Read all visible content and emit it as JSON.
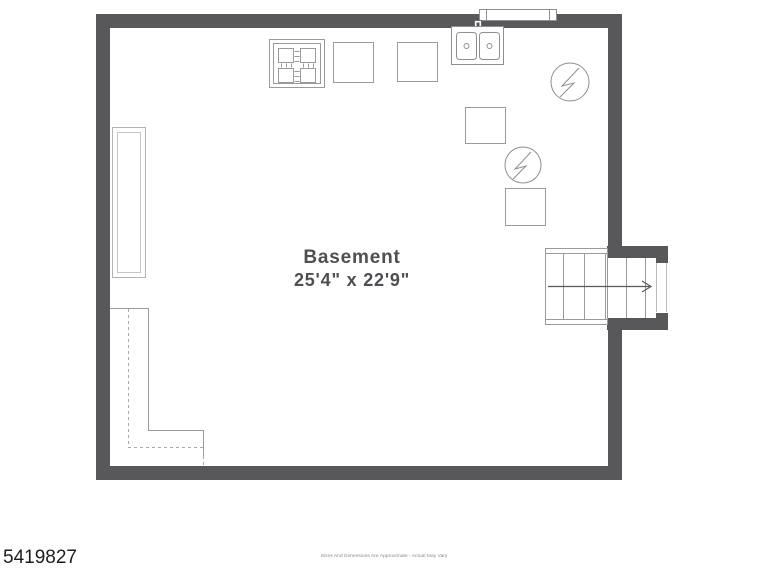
{
  "plan": {
    "room_label": "Basement",
    "room_dimensions": "25'4\" x 22'9\"",
    "fixture_icons": [
      "range-icon",
      "appliance-square-icon",
      "appliance-square-icon",
      "double-sink-icon",
      "window-icon",
      "water-heater-icon",
      "appliance-square-icon",
      "water-heater-icon",
      "appliance-square-icon",
      "shelving-unit-icon",
      "stairs-icon",
      "stairs-direction-arrow-icon",
      "crawlspace-dashed-outline"
    ]
  },
  "footer": {
    "listing_id": "5419827",
    "disclaimer": "Sizes And Dimensions Are Approximate - Actual May Vary"
  },
  "colors": {
    "wall": "#58585b",
    "fixture_stroke": "#9a9a9e",
    "label_text": "#4f4f53",
    "background": "#ffffff"
  }
}
